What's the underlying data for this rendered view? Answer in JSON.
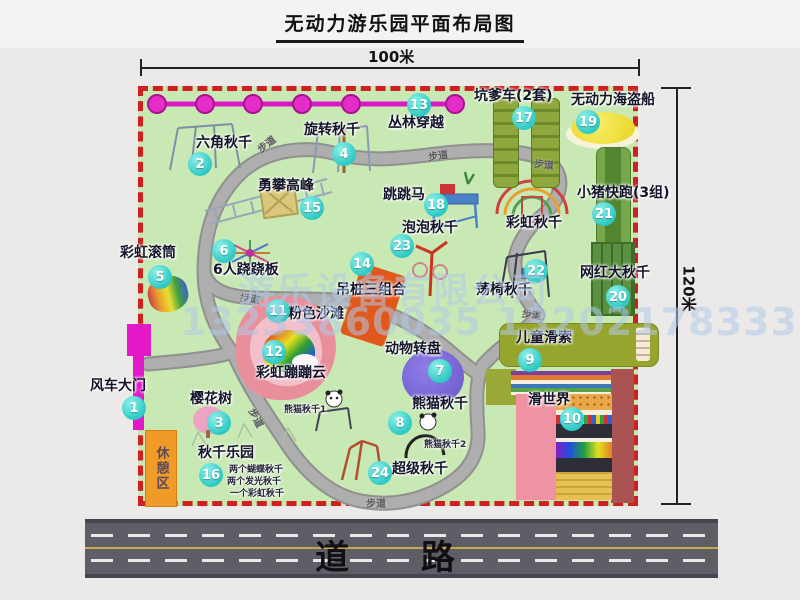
{
  "title": "无动力游乐园平面布局图",
  "dimensions": {
    "width": "100米",
    "height": "120米"
  },
  "road": {
    "label": "道 路"
  },
  "watermark": {
    "company": "游乐设备有限公司",
    "phone": "13233860035 13202178333"
  },
  "rest_area": "休憩区",
  "path_label": "步道",
  "rainbow_swing": "彩虹秋千",
  "panda_swing_1": "熊猫秋千1",
  "panda_swing_2": "熊猫秋千2",
  "swing_park_details": {
    "line1": "两个蝴蝶秋千",
    "line2": "两个发光秋千",
    "line3": "一个彩虹秋千"
  },
  "colors": {
    "map_green": "#c9e9b4",
    "border_red": "#cf1f1f",
    "badge_teal": "#2ec9c4",
    "zipline_magenta": "#e32cc8",
    "gate_magenta": "#e318c9",
    "rest_orange": "#f09a28"
  },
  "attractions": [
    {
      "num": "1",
      "name": "风车大门"
    },
    {
      "num": "2",
      "name": "六角秋千"
    },
    {
      "num": "3",
      "name": "樱花树"
    },
    {
      "num": "4",
      "name": "旋转秋千"
    },
    {
      "num": "5",
      "name": "彩虹滚筒"
    },
    {
      "num": "6",
      "name": "6人跷跷板"
    },
    {
      "num": "7",
      "name": "动物转盘"
    },
    {
      "num": "8",
      "name": "熊猫秋千"
    },
    {
      "num": "9",
      "name": "儿童滑索"
    },
    {
      "num": "10",
      "name": "滑世界"
    },
    {
      "num": "11",
      "name": "粉色沙滩"
    },
    {
      "num": "12",
      "name": "彩虹蹦蹦云"
    },
    {
      "num": "13",
      "name": "丛林穿越"
    },
    {
      "num": "14",
      "name": "吊桩三组合"
    },
    {
      "num": "15",
      "name": "勇攀高峰"
    },
    {
      "num": "16",
      "name": "秋千乐园"
    },
    {
      "num": "17",
      "name": "坑爹车(2套)"
    },
    {
      "num": "18",
      "name": "跳跳马"
    },
    {
      "num": "19",
      "name": "无动力海盗船"
    },
    {
      "num": "20",
      "name": "网红大秋千"
    },
    {
      "num": "21",
      "name": "小猪快跑(3组)"
    },
    {
      "num": "22",
      "name": "荡椅秋千"
    },
    {
      "num": "23",
      "name": "泡泡秋千"
    },
    {
      "num": "24",
      "name": "超级秋千"
    }
  ]
}
